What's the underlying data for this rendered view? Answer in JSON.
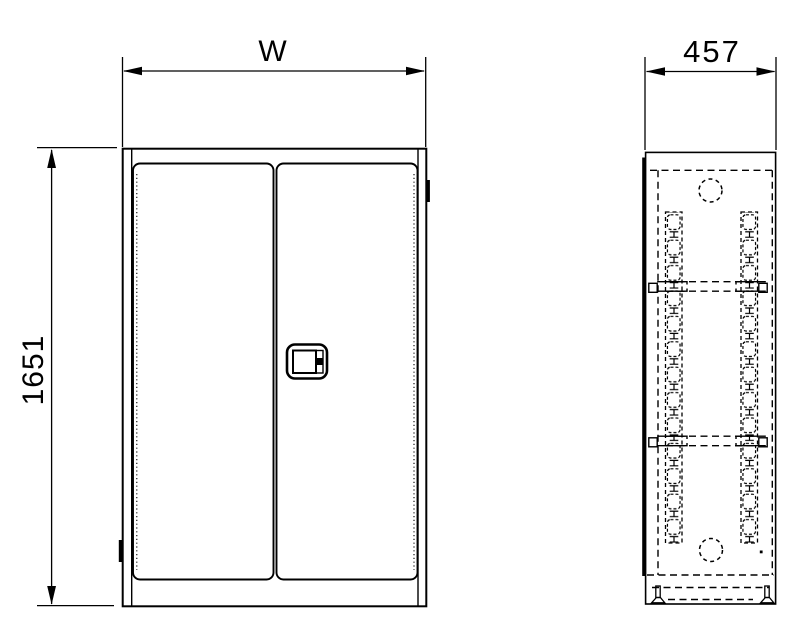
{
  "dimensions": {
    "width": "W",
    "height": "1651",
    "depth": "457"
  },
  "colors": {
    "line": "#000000",
    "background": "#ffffff"
  }
}
